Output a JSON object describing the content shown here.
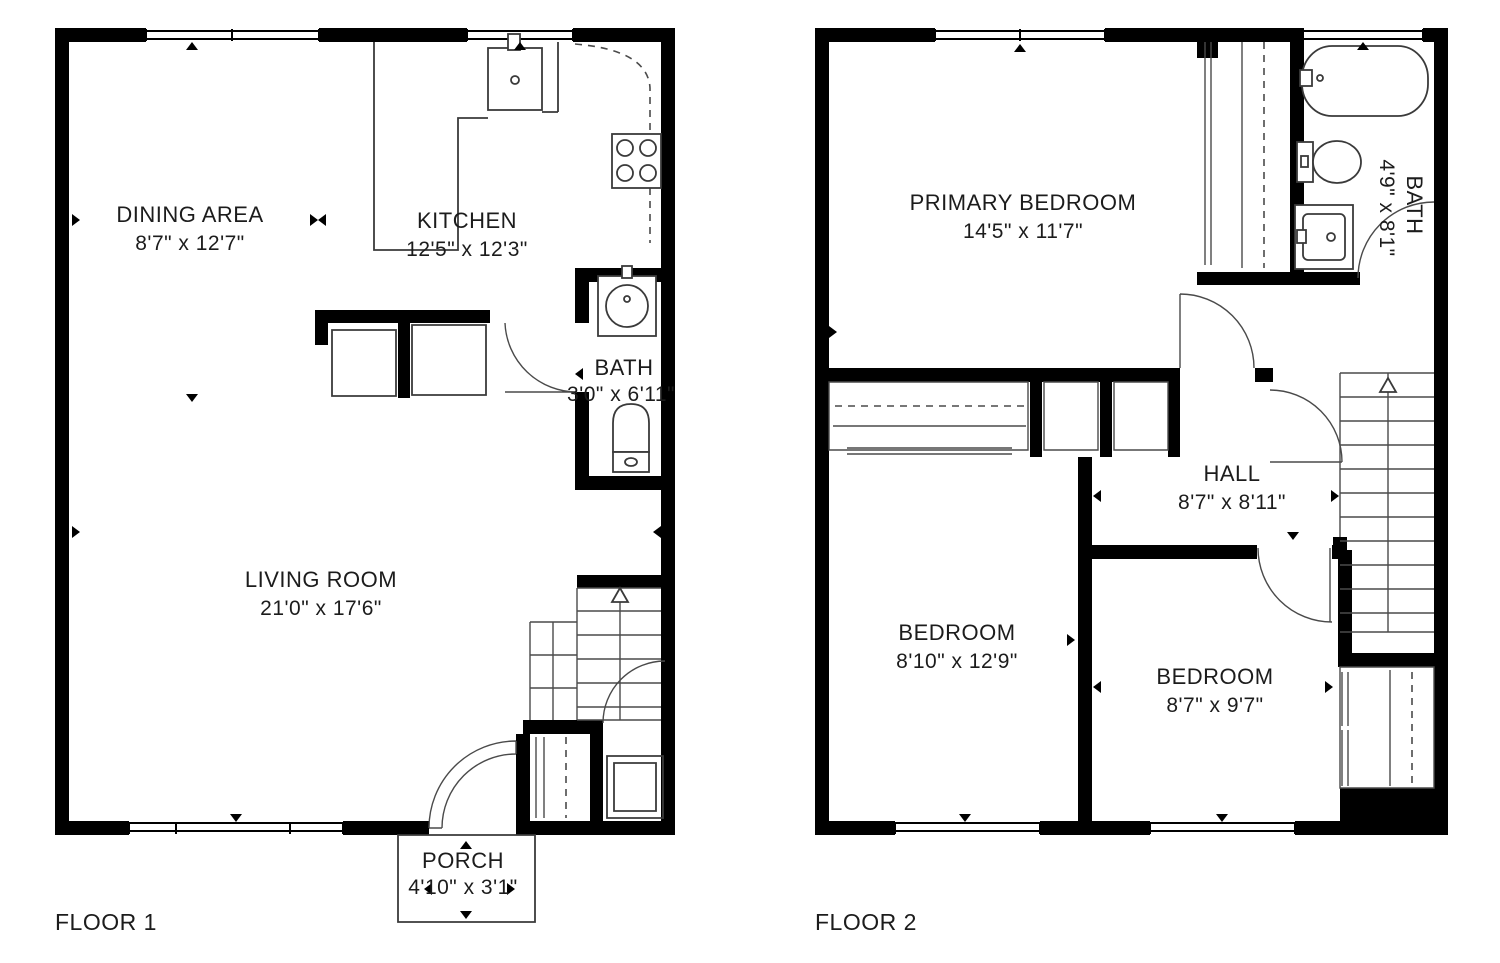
{
  "colors": {
    "background": "#ffffff",
    "walls": "#000000",
    "thin_lines": "#3a3a3a",
    "text": "#1c1c1c"
  },
  "floor1": {
    "label": "FLOOR 1",
    "rooms": [
      {
        "name": "DINING AREA",
        "dims": "8'7\" x 12'7\""
      },
      {
        "name": "KITCHEN",
        "dims": "12'5\" x 12'3\""
      },
      {
        "name": "BATH",
        "dims": "3'0\" x 6'11\""
      },
      {
        "name": "LIVING ROOM",
        "dims": "21'0\" x 17'6\""
      },
      {
        "name": "PORCH",
        "dims": "4'10\" x 3'1\""
      }
    ]
  },
  "floor2": {
    "label": "FLOOR 2",
    "rooms": [
      {
        "name": "PRIMARY BEDROOM",
        "dims": "14'5\" x 11'7\""
      },
      {
        "name": "BATH",
        "dims": "4'9\" x 8'1\""
      },
      {
        "name": "HALL",
        "dims": "8'7\" x 8'11\""
      },
      {
        "name": "BEDROOM",
        "dims": "8'10\" x 12'9\""
      },
      {
        "name": "BEDROOM",
        "dims": "8'7\" x 9'7\""
      }
    ]
  },
  "icons": {
    "bathtub": "bathtub-icon",
    "toilet": "toilet-icon",
    "sink": "sink-icon",
    "stove": "stove-icon",
    "stairs_up": "stairs-up-icon",
    "door_swing": "door-swing-icon",
    "closet_rod": "closet-rod-icon",
    "window": "window-icon"
  }
}
